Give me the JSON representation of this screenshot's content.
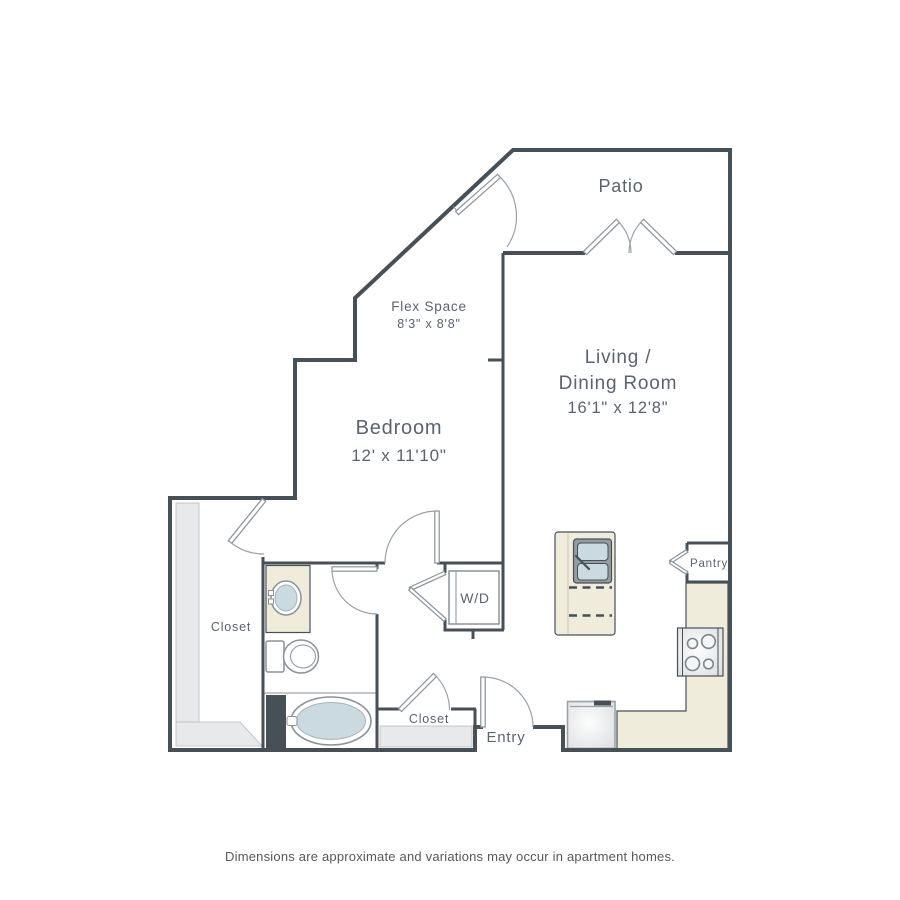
{
  "page": {
    "disclaimer": "Dimensions are approximate and variations may occur in apartment homes."
  },
  "rooms": {
    "patio": {
      "label": "Patio"
    },
    "flex": {
      "label": "Flex Space",
      "dims": "8'3\" x 8'8\""
    },
    "living": {
      "label_line1": "Living /",
      "label_line2": "Dining Room",
      "dims": "16'1\" x 12'8\""
    },
    "bedroom": {
      "label": "Bedroom",
      "dims": "12' x 11'10\""
    },
    "walk_in_closet": {
      "label": "Closet"
    },
    "hall_closet": {
      "label": "Closet"
    },
    "entry": {
      "label": "Entry"
    },
    "pantry": {
      "label": "Pantry"
    },
    "laundry": {
      "label": "W/D"
    }
  },
  "colors": {
    "wall": "#474f57",
    "fixture_line": "#8a9298",
    "counter": "#efecdc",
    "water": "#cbdae0",
    "shelf": "#e8e9eb",
    "text": "#5a646d"
  }
}
